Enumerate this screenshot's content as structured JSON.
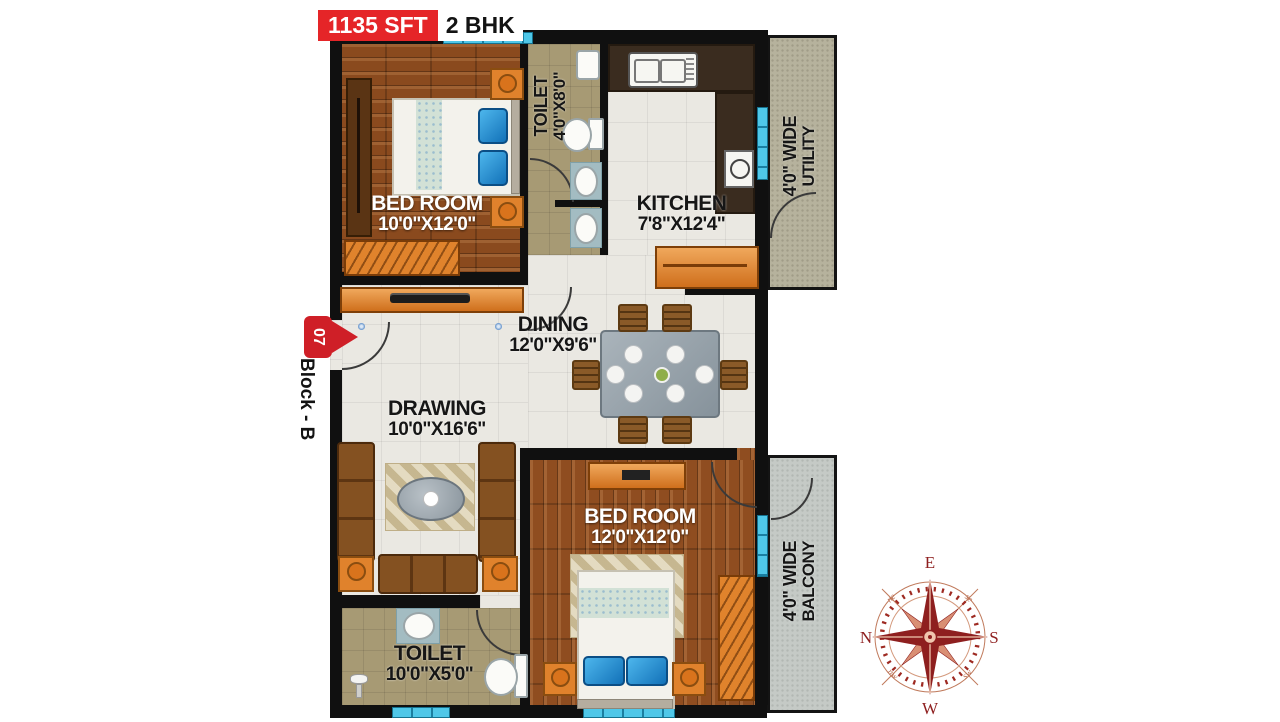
{
  "header": {
    "area_label": "1135 SFT",
    "bhk_label": "2 BHK"
  },
  "block_marker": {
    "number": "07",
    "label": "Block - B"
  },
  "rooms": {
    "bedroom1": {
      "name": "BED ROOM",
      "size": "10'0\"X12'0\""
    },
    "toilet1": {
      "name": "TOILET",
      "size": "4'0\"X8'0\""
    },
    "kitchen": {
      "name": "KITCHEN",
      "size": "7'8\"X12'4\""
    },
    "utility": {
      "line1": "4'0\" WIDE",
      "line2": "UTILITY"
    },
    "dining": {
      "name": "DINING",
      "size": "12'0\"X9'6\""
    },
    "drawing": {
      "name": "DRAWING",
      "size": "10'0\"X16'6\""
    },
    "bedroom2": {
      "name": "BED ROOM",
      "size": "12'0\"X12'0\""
    },
    "balcony": {
      "line1": "4'0\" WIDE",
      "line2": "BALCONY"
    },
    "toilet2": {
      "name": "TOILET",
      "size": "10'0\"X5'0\""
    }
  },
  "compass": {
    "n": "N",
    "e": "E",
    "s": "S",
    "w": "W",
    "ne": "ne",
    "se": "se",
    "nw": "nw",
    "sw": "sw"
  },
  "colors": {
    "accent_red": "#e52528",
    "badge_red": "#cf1f27",
    "window_cyan": "#4fc7e8",
    "wall_black": "#101010",
    "furniture_orange": "#e0822c",
    "compass_red": "#8e1f1f"
  }
}
